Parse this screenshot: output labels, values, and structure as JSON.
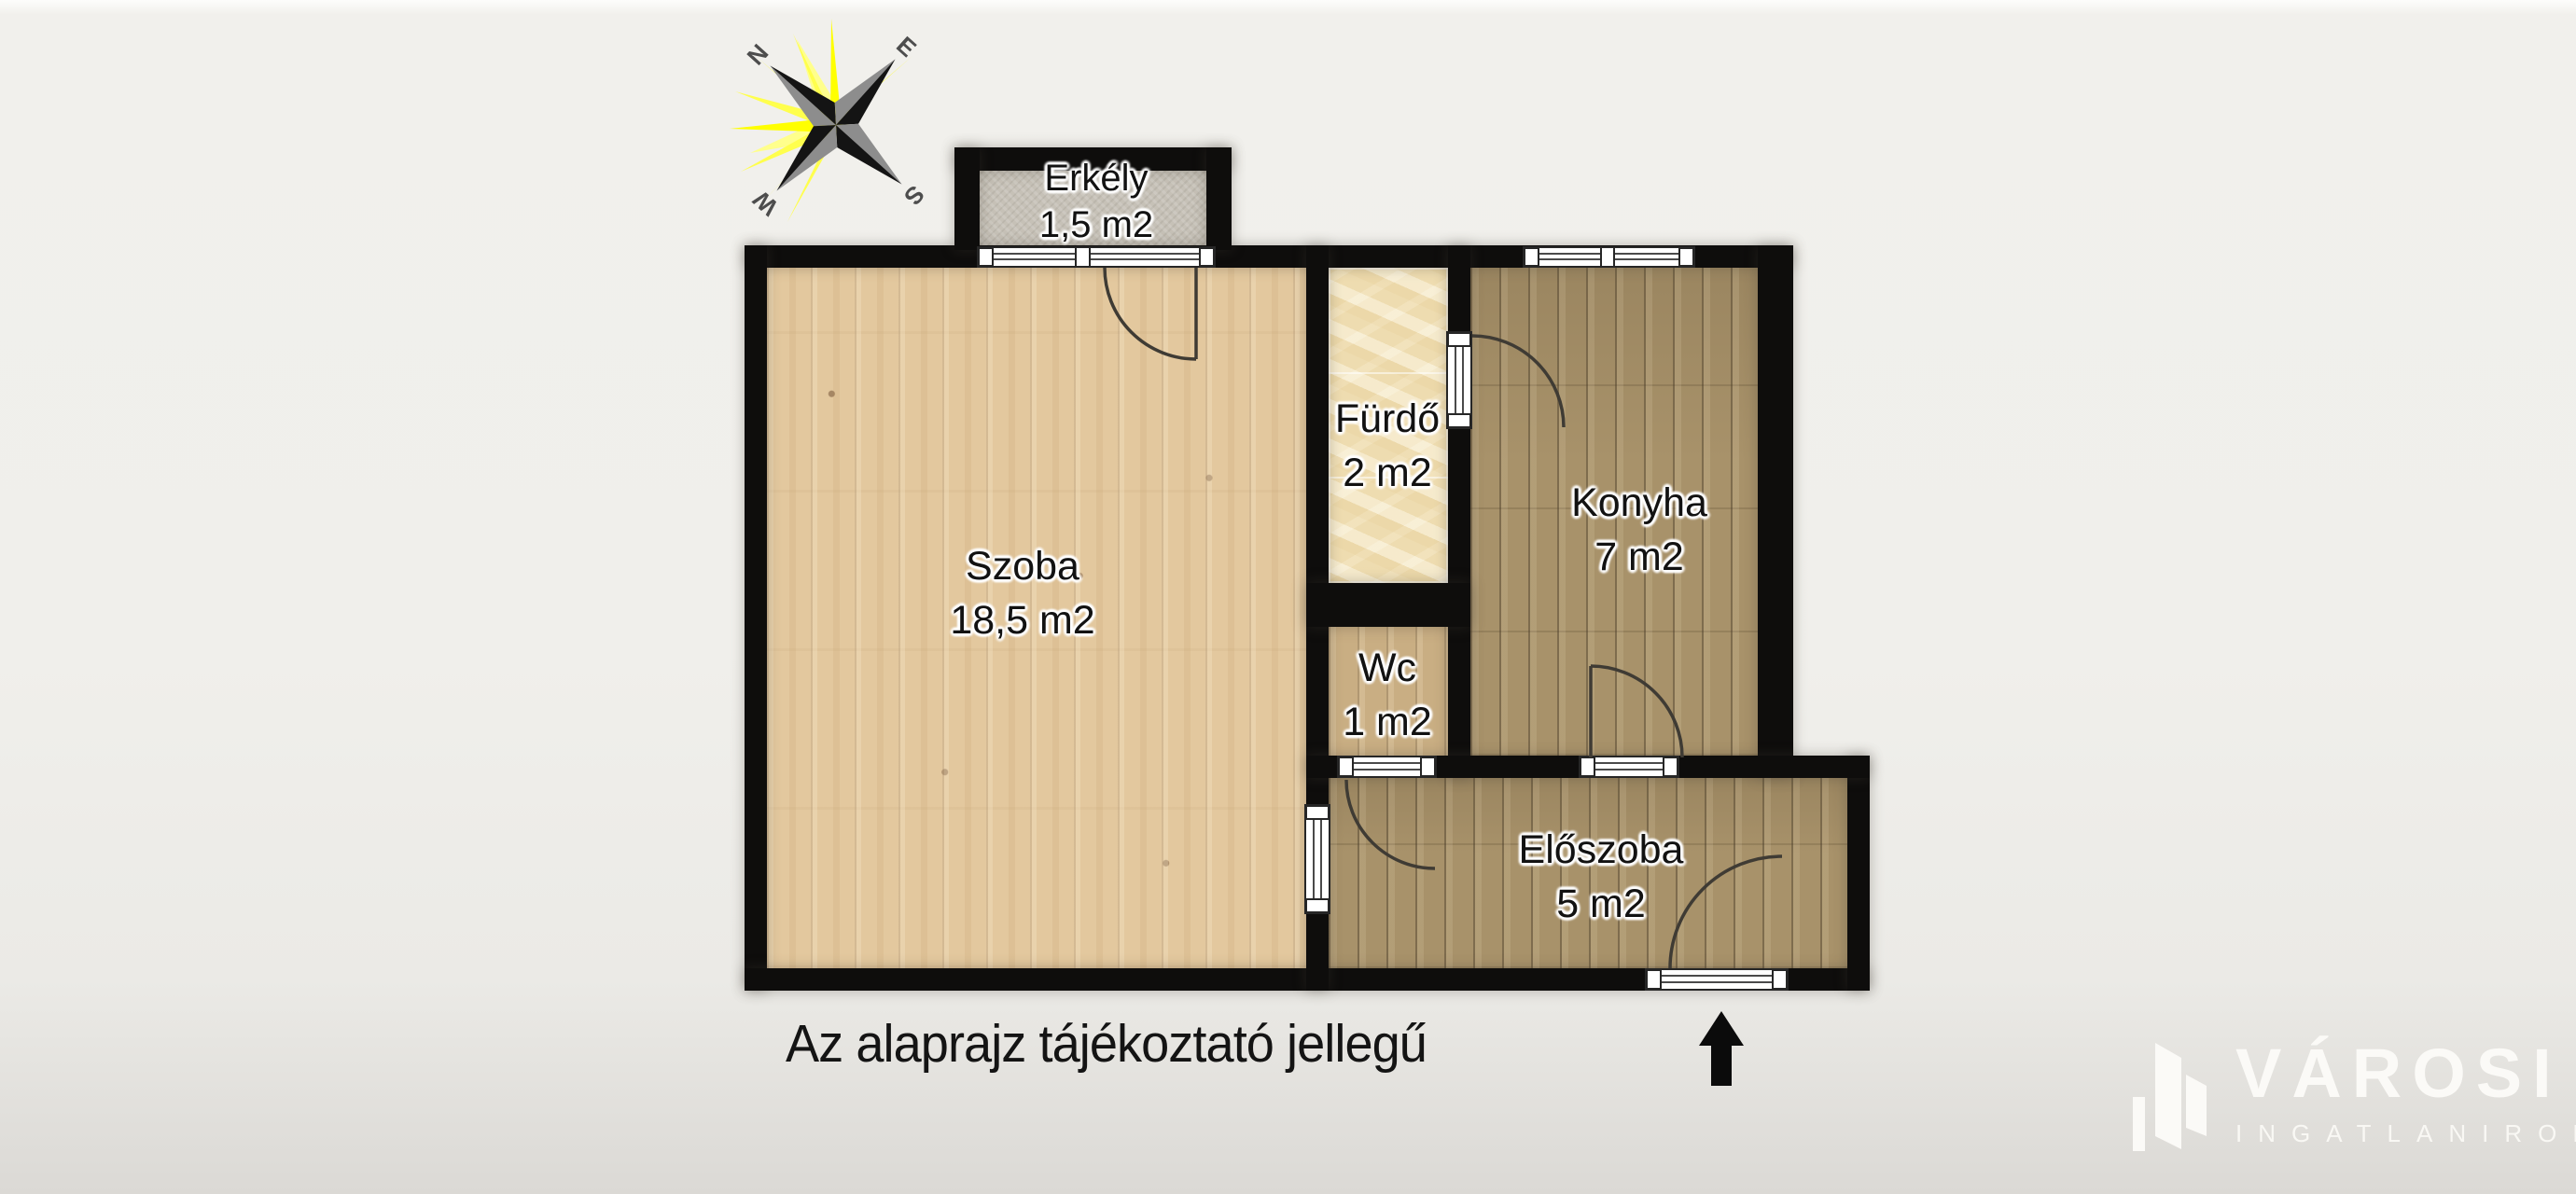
{
  "caption": "Az alaprajz tájékoztató jellegű",
  "compass": {
    "n": "N",
    "e": "E",
    "s": "S",
    "w": "W"
  },
  "rooms": [
    {
      "id": "erkely",
      "name": "Erkély",
      "area": "1,5 m2"
    },
    {
      "id": "szoba",
      "name": "Szoba",
      "area": "18,5 m2"
    },
    {
      "id": "furdo",
      "name": "Fürdő",
      "area": "2 m2"
    },
    {
      "id": "konyha",
      "name": "Konyha",
      "area": "7 m2"
    },
    {
      "id": "wc",
      "name": "Wc",
      "area": "1 m2"
    },
    {
      "id": "eloszoba",
      "name": "Előszoba",
      "area": "5 m2"
    }
  ],
  "logo": {
    "brand": "VÁROSI",
    "subtitle": "INGATLANIRODA"
  },
  "colors": {
    "background": "#f0efeb",
    "wall": "#0e0d0c",
    "szoba_floor": "#e3c89e",
    "konyha_floor": "#a8926a",
    "wc_floor": "#c9ae83",
    "furdo_floor": "#f0e1bb",
    "erkely_floor": "#c6c1b7",
    "compass_ray": "#ffff2e",
    "logo_text": "#fbfaf7"
  }
}
